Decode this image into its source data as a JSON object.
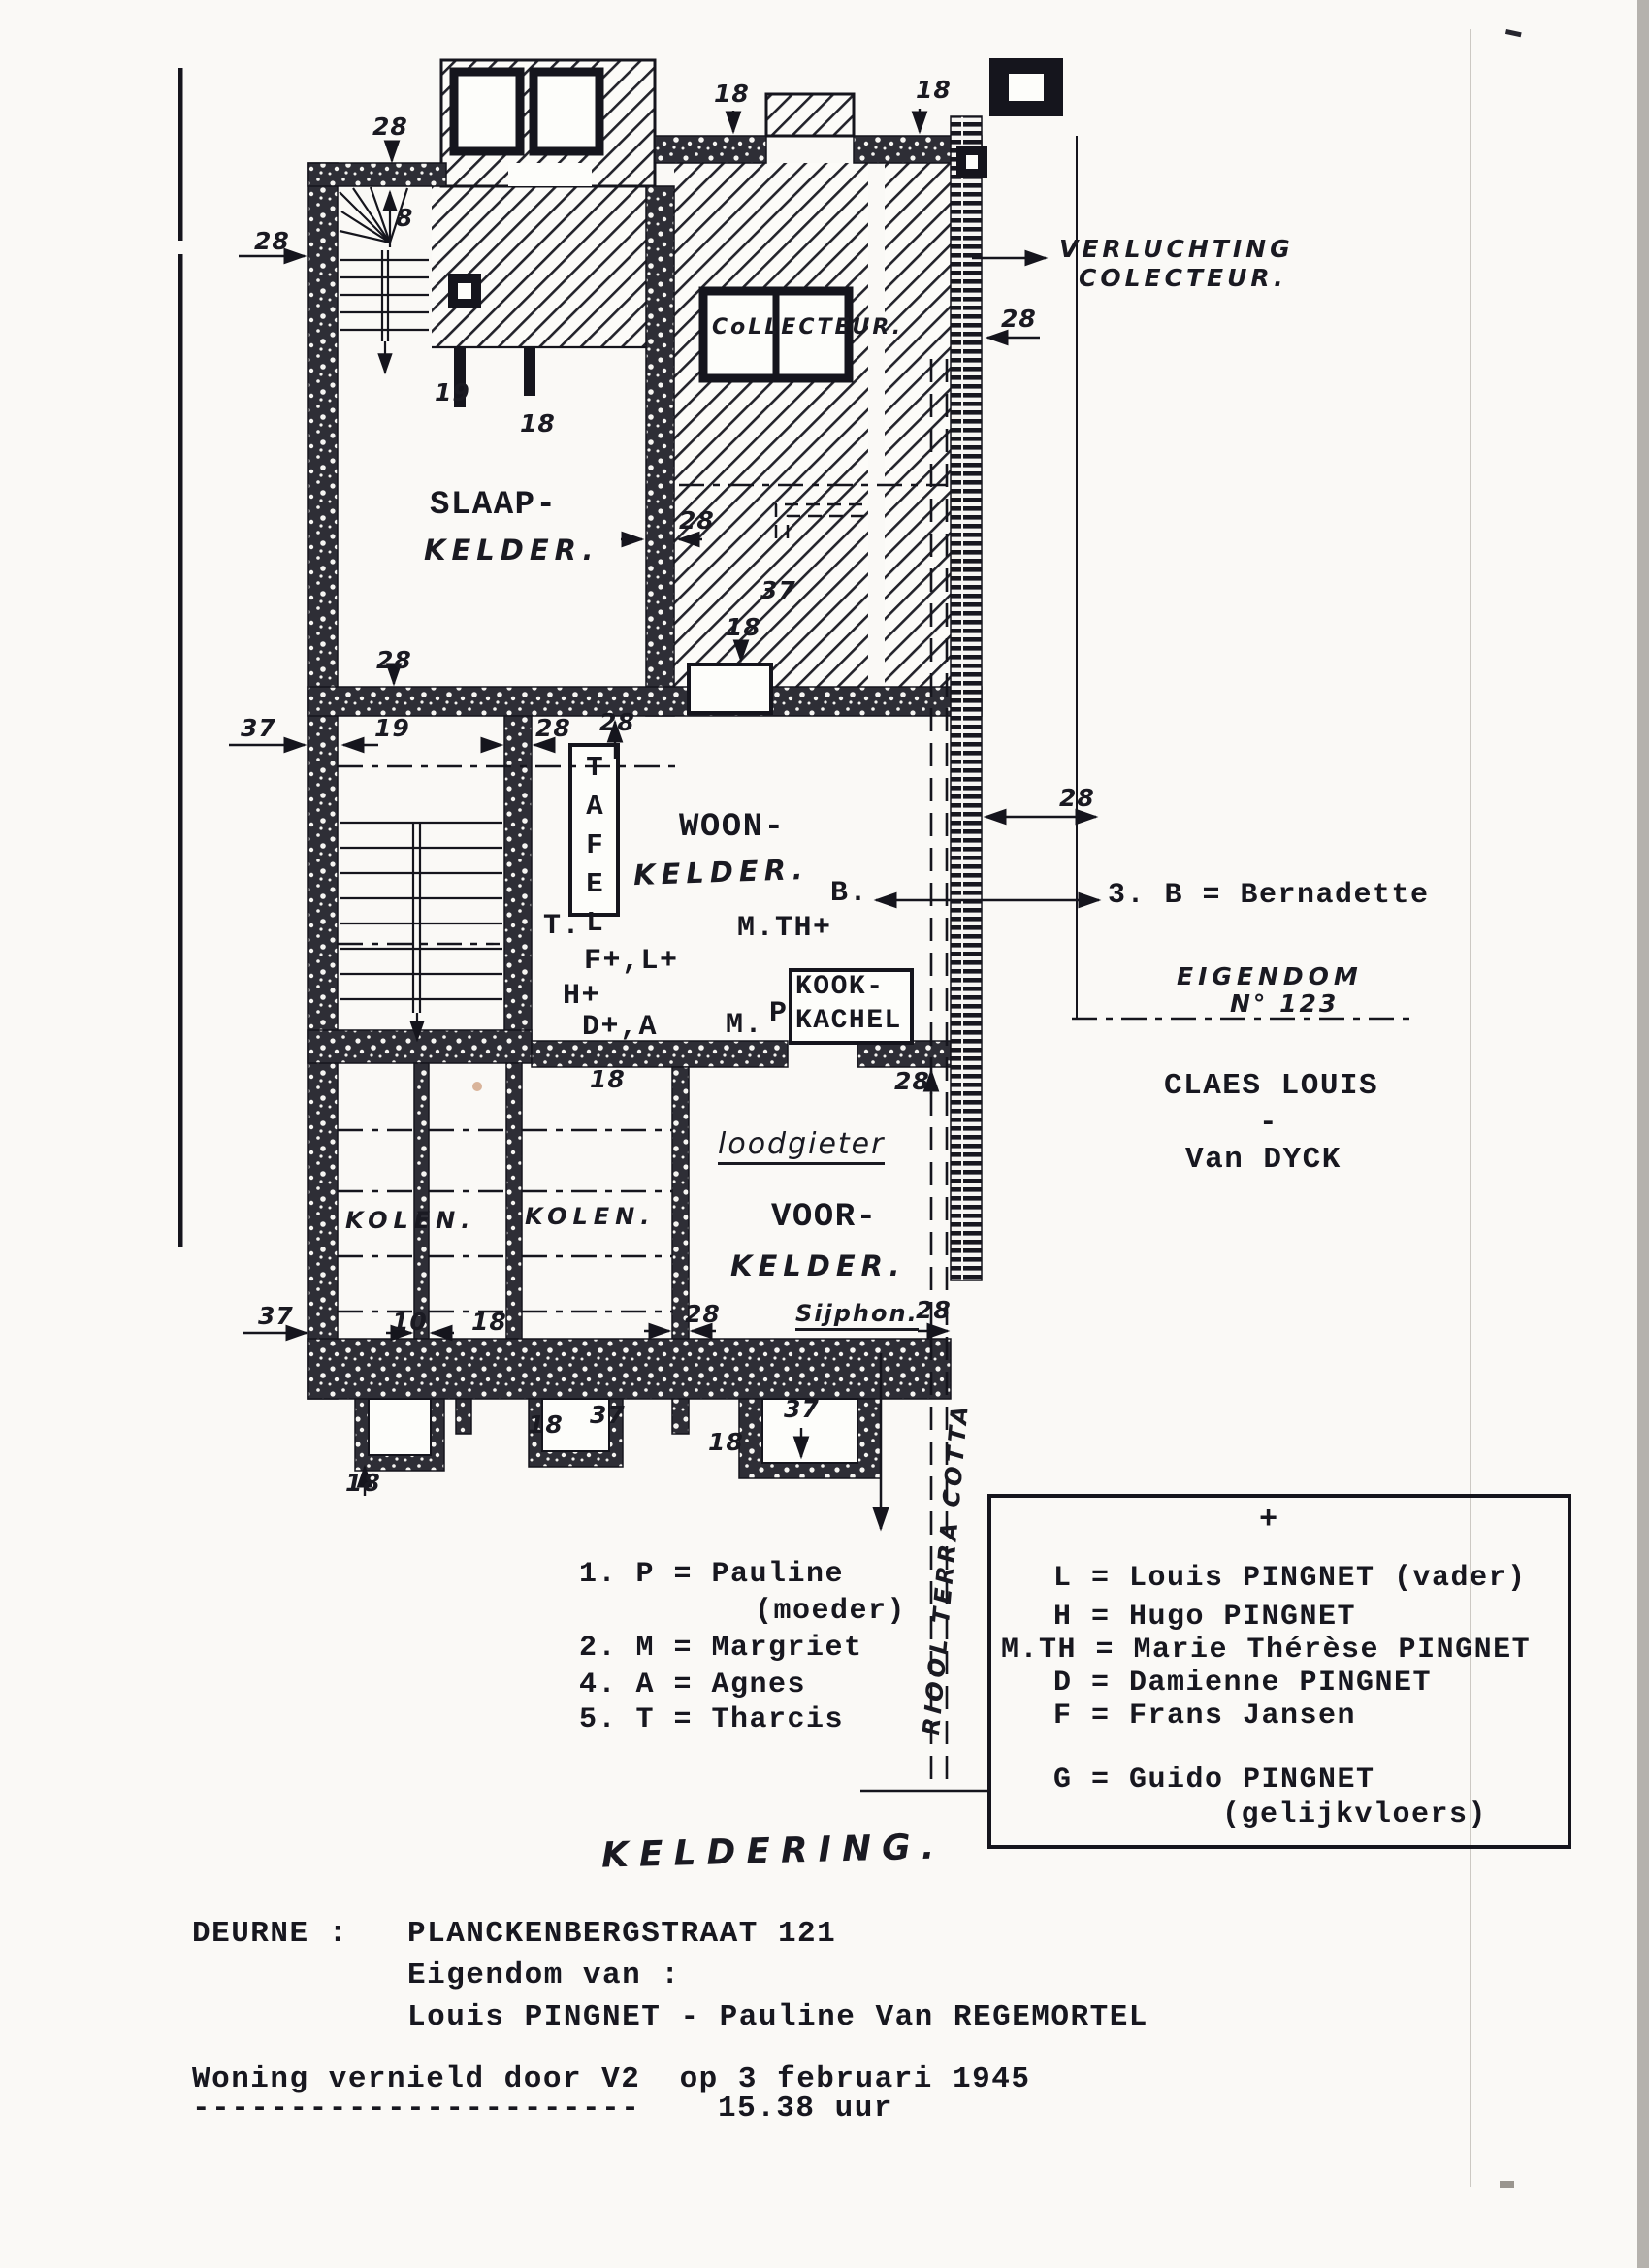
{
  "colors": {
    "ink": "#1b1b22",
    "paper": "#faf9f6"
  },
  "plan": {
    "rooms": {
      "slaap_line1": "SLAAP-",
      "slaap_line2": "KELDER.",
      "woon_line1": "WOON-",
      "woon_line2": "KELDER.",
      "voor_line1": "VOOR-",
      "voor_line2": "KELDER.",
      "kolen_a": "KOLEN.",
      "kolen_b": "KOLEN.",
      "tafel": "TAFEL",
      "kook_line1": "KOOK-",
      "kook_line2": "KACHEL",
      "collecteur": "CoLLECTEUR.",
      "loodgieter": "loodgieter",
      "sijphon": "Sijphon.",
      "keldering": "KELDERING.",
      "riool": "RIOOL TERRA COTTA",
      "verluchting_line1": "VERLUCHTING",
      "verluchting_line2": "COLECTEUR.",
      "eigendom_line1": "EIGENDOM",
      "eigendom_line2": "N° 123"
    },
    "occupants": {
      "t": "T.",
      "fl": "F+,L+",
      "h": "H+",
      "da": "D+,A",
      "m": "M.",
      "p": "P",
      "mth": "M.TH+",
      "b": "B."
    },
    "dims": {
      "d1": "28",
      "d2": "8",
      "d3": "28",
      "d4": "19",
      "d5": "18",
      "d6": "18",
      "d7": "18",
      "d8": "28",
      "d9": "18",
      "d10": "37",
      "d11": "28",
      "d12": "37",
      "d13": "19",
      "d14": "28",
      "d15": "28",
      "d16": "28",
      "d17": "28",
      "d18": "28",
      "d19": "18",
      "d20": "37",
      "d21": "10",
      "d22": "18",
      "d23": "28",
      "d24": "28",
      "d25": "18",
      "d26": "18",
      "d27": "37",
      "d28": "18",
      "d29": "37"
    }
  },
  "annotations": {
    "bernadette": "3. B = Bernadette",
    "owner_line1": "CLAES LOUIS",
    "owner_dash": "-",
    "owner_line2": "Van DYCK"
  },
  "legend_left": {
    "l1": "1. P = Pauline",
    "l2": "(moeder)",
    "l3": "2. M = Margriet",
    "l4": "4. A = Agnes",
    "l5": "5. T = Tharcis"
  },
  "legend_box": {
    "plus": "+",
    "rows": {
      "r1": "L = Louis PINGNET (vader)",
      "r2": "H = Hugo PINGNET",
      "r3": "M.TH = Marie Thérèse PINGNET",
      "r4": "D = Damienne PINGNET",
      "r5": "F = Frans Jansen",
      "r6": "G = Guido PINGNET",
      "r7": "(gelijkvloers)"
    }
  },
  "footer": {
    "line1_label": "DEURNE :",
    "line1_value": "PLANCKENBERGSTRAAT 121",
    "line2": "Eigendom van :",
    "line3": "Louis PINGNET - Pauline Van REGEMORTEL",
    "line4": "Woning vernield door V2  op 3 februari 1945",
    "line5_dashes": "-----------------------",
    "line5_time": "15.38 uur"
  }
}
